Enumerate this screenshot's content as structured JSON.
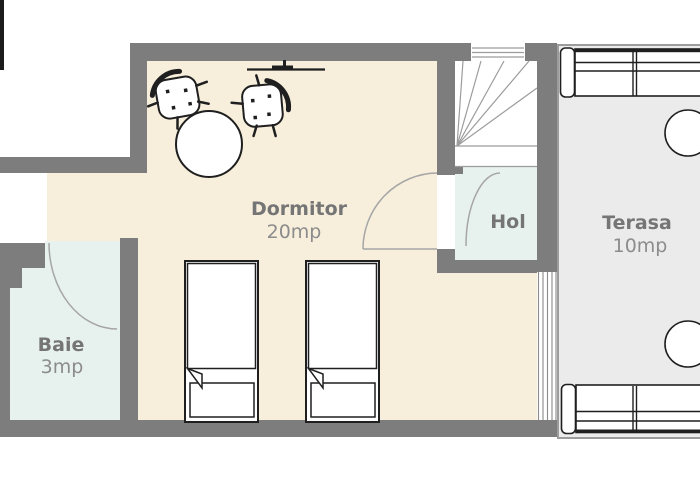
{
  "title": "Apartment floor plan",
  "rooms": [
    {
      "key": "dormitor",
      "name": "Dormitor",
      "area": "20mp"
    },
    {
      "key": "hol",
      "name": "Hol",
      "area": ""
    },
    {
      "key": "terasa",
      "name": "Terasa",
      "area": "10mp"
    },
    {
      "key": "baie",
      "name": "Baie",
      "area": "3mp"
    }
  ],
  "furniture": [
    "single-bed",
    "single-bed",
    "round-table",
    "chair",
    "chair",
    "sofa",
    "sofa",
    "terrace-table",
    "terrace-table",
    "staircase",
    "wall-fixture",
    "door-swing",
    "door-swing",
    "door-swing",
    "window"
  ],
  "colors": {
    "wall": "#7d7d7d",
    "bedroom_floor": "#f7efdc",
    "bath_hall_floor": "#e7f2ee",
    "terrace_floor": "#ebebeb",
    "room_label": "#757575",
    "area_label": "#8c8c8c",
    "furniture_line": "#1f1f1f",
    "door_arc": "#a6a6a6",
    "stair_line": "#9c9c9c",
    "outline": "#9c9c9c",
    "window_frame": "#1c1c1c",
    "glazing_line": "#8a8a8a"
  }
}
